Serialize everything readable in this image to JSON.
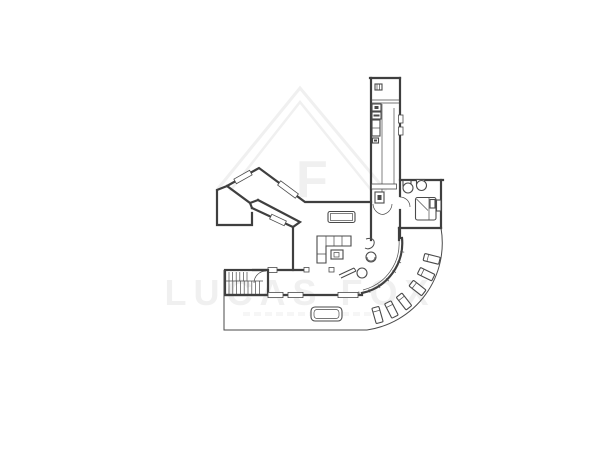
{
  "palette": {
    "background": "#ffffff",
    "ink": "#4a4a4a",
    "wall": "#3f3f3f",
    "watermark": "#f0f0f0"
  },
  "watermark": {
    "brand": "LUCAS FOX",
    "monogram": "F",
    "logo": "house-roof-logo"
  },
  "plan": {
    "type": "architectural-floor-plan",
    "description": "Black-and-white line drawing of a single floor plan: angular zigzag window wing at left, long service corridor at top, corner bedroom at top right, open-plan living area with sofa and dining table, staircase at lower left, straight glazed south facade and a quarter-circle glazed wall opening onto a curved sun terrace with loungers",
    "elements": [
      "zigzag-window-wing",
      "service-corridor",
      "corner-bedroom",
      "open-plan-living-area",
      "double-swing-door",
      "dining-table",
      "corner-sofa",
      "coffee-table",
      "chaise-chair",
      "round-chair",
      "staircase",
      "south-facade-windows",
      "curved-glazed-wall",
      "curved-sun-terrace",
      "sun-loungers",
      "terrace-table",
      "lower-terrace"
    ]
  }
}
